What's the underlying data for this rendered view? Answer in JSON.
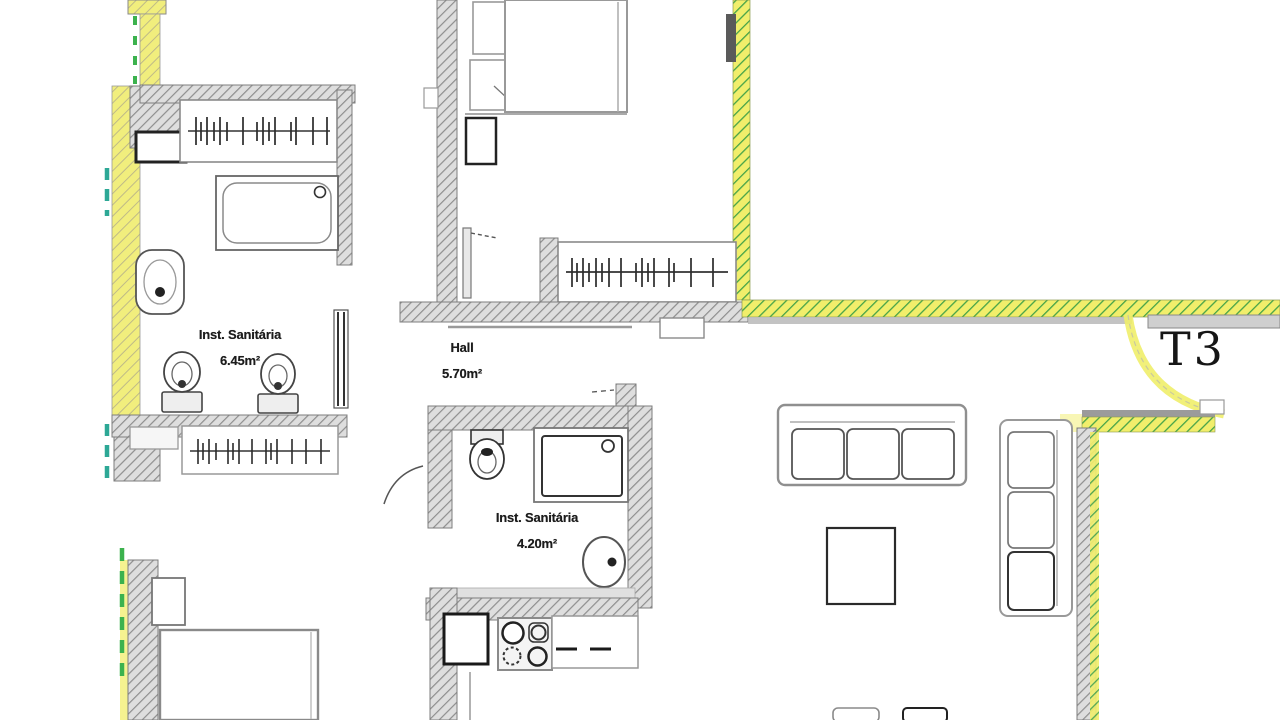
{
  "plan": {
    "type_label": "T3",
    "drawing_kind": "apartment floor plan (scanned architectural drawing)"
  },
  "rooms": [
    {
      "id": "inst-sanitaria-1",
      "name": "Inst. Sanitária",
      "area": "6.45m²"
    },
    {
      "id": "hall",
      "name": "Hall",
      "area": "5.70m²"
    },
    {
      "id": "inst-sanitaria-2",
      "name": "Inst. Sanitária",
      "area": "4.20m²"
    }
  ],
  "fixtures": [
    "wardrobe-hangers",
    "bathtub",
    "washbasin",
    "toilet",
    "bidet",
    "towel-radiator",
    "double-bed",
    "nightstand",
    "closet-hangers",
    "wall-hung-toilet",
    "shower-tray",
    "washbasin-small",
    "kitchen-sink",
    "stove-4-burners",
    "kitchen-counter",
    "sofa-3-seat-horizontal",
    "sofa-3-seat-vertical",
    "square-table",
    "dining-chairs",
    "entrance-door-swing",
    "interior-door-leaf",
    "bed-bottom"
  ],
  "colors": {
    "paper": "#ffffff",
    "wall_fill": "#dedede",
    "wall_hatch": "#8e8e8e",
    "highlight_yellow": "#f1ee6b",
    "hatch_green": "#44a348",
    "boundary_teal": "#2da896",
    "boundary_green": "#3cb24e",
    "ink": "#1f1f1f"
  }
}
